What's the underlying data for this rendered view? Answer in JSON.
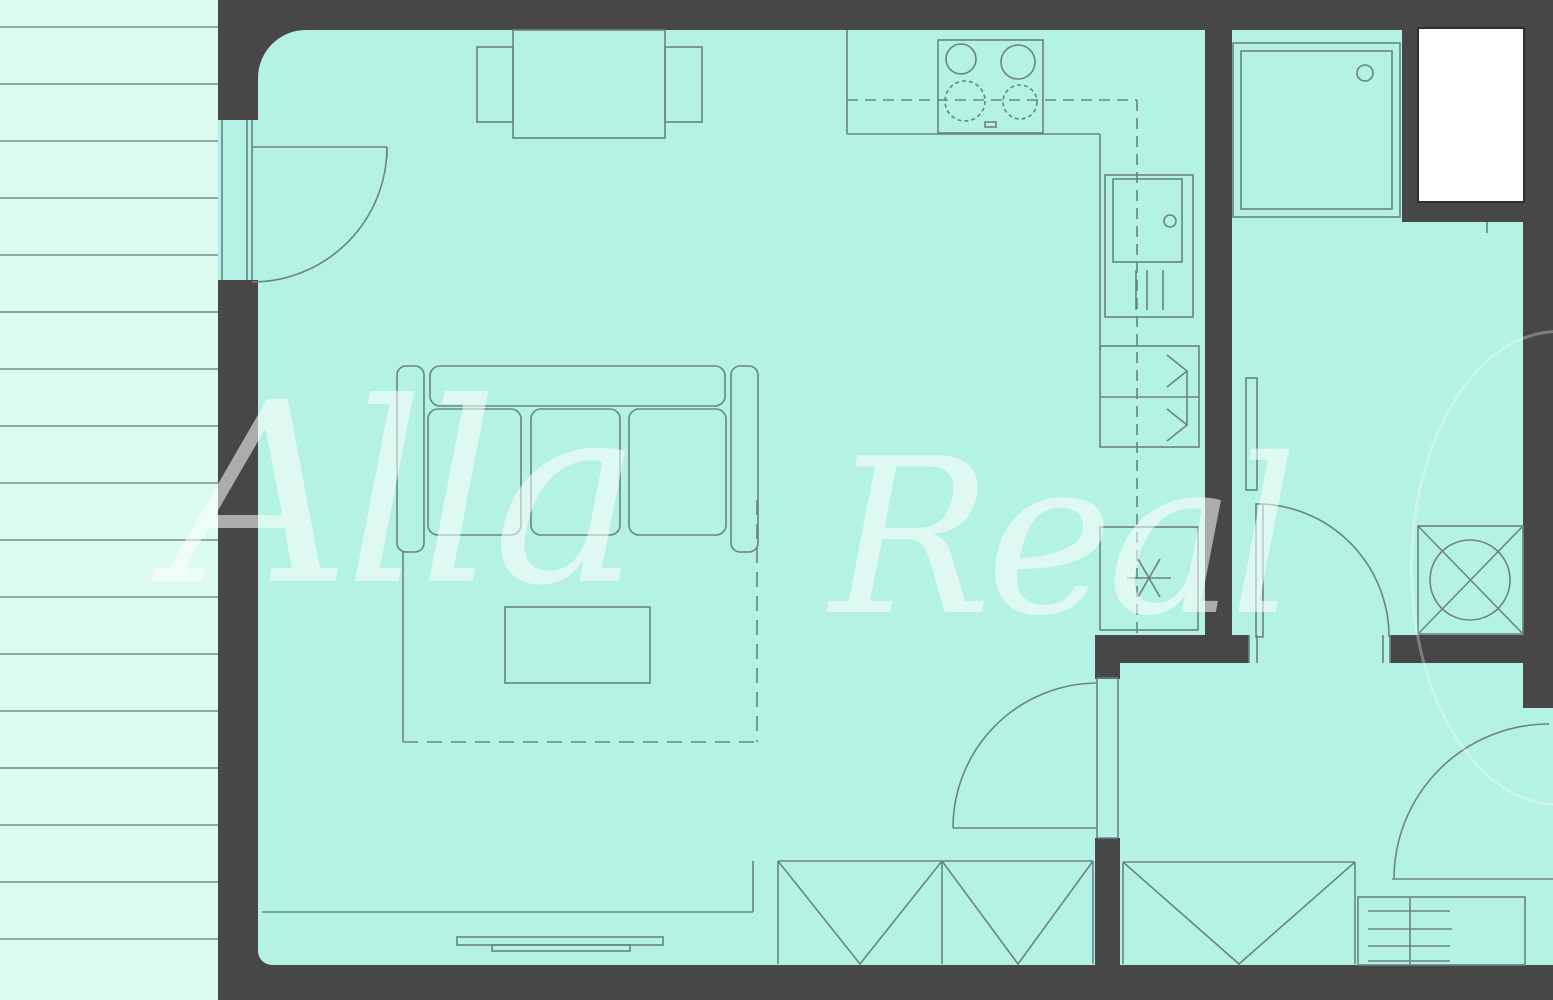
{
  "document": {
    "type": "apartment-floor-plan",
    "description": "2D architectural floor plan; mint-green rooms on dark gray walls, staircase strip on the left, watermarked"
  },
  "watermark": {
    "word_left": "Alla",
    "word_right": "Real"
  },
  "palette": {
    "wall": "#474747",
    "room_fill": "#b4f2e3",
    "stairs_fill": "#dbfbf1",
    "stair_line": "#8fa9a1",
    "line": "#6a8482",
    "shaft_fill": "#ffffff",
    "watermark": "rgba(255,255,255,0.55)"
  },
  "elements": {
    "rooms": [
      "staircase",
      "living-room-with-kitchen",
      "shower-room",
      "entrance-hall",
      "shaft"
    ],
    "fixtures": [
      "dining-table",
      "chairs",
      "stove-4-burners",
      "kitchen-counter",
      "fridge-unit",
      "cabinet-with-door-arrows",
      "freezer-unit",
      "sofa-3-seat",
      "rug",
      "coffee-table",
      "radiators",
      "windows",
      "shower-tray",
      "towel-radiator",
      "washing-machine",
      "swing-doors"
    ]
  }
}
